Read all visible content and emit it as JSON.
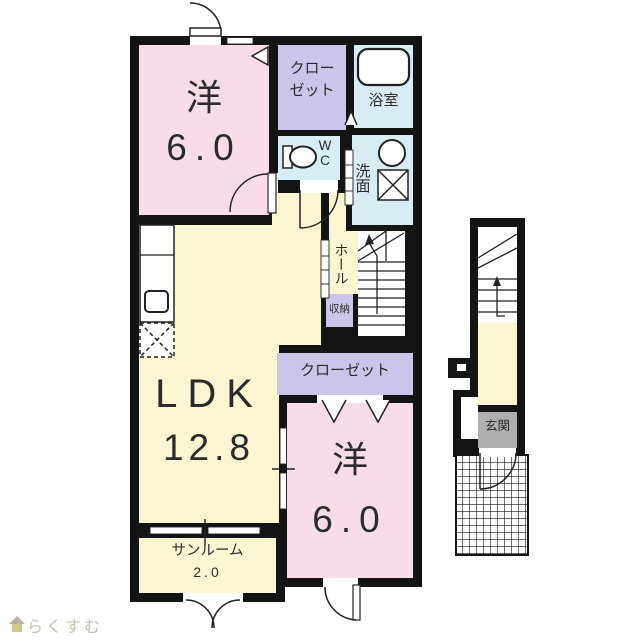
{
  "plan_type": "floor-plan",
  "rooms": {
    "bedroom_top": {
      "label": "洋",
      "size": "6.0"
    },
    "closet_top": {
      "label": "クロー\nゼット"
    },
    "bath": {
      "label": "浴室"
    },
    "wc": {
      "label": "W\nC"
    },
    "washroom": {
      "label": "洗面"
    },
    "hall": {
      "label": "ホール"
    },
    "storage": {
      "label": "収納"
    },
    "closet_bottom": {
      "label": "クローゼット"
    },
    "ldk": {
      "label": "LDK",
      "size": "12.8"
    },
    "sunroom": {
      "label": "サンルーム",
      "size": "2.0"
    },
    "bedroom_bottom": {
      "label": "洋",
      "size": "6.0"
    },
    "entrance": {
      "label": "玄関"
    }
  },
  "colors": {
    "wall": "#141414",
    "room_pink": "#F8DCE9",
    "room_yellow": "#FBF6D1",
    "room_lavender": "#CBC5EC",
    "room_blue": "#D8ECF3",
    "genkan_gray": "#AFAFAF",
    "fixture_white": "#FFFFFF",
    "line": "#222222",
    "logo_text_color": "#C8C0B0",
    "logo_roof": "#B9B2A2",
    "logo_body": "#CDC98F"
  },
  "brand": {
    "text": "らくすむ"
  }
}
